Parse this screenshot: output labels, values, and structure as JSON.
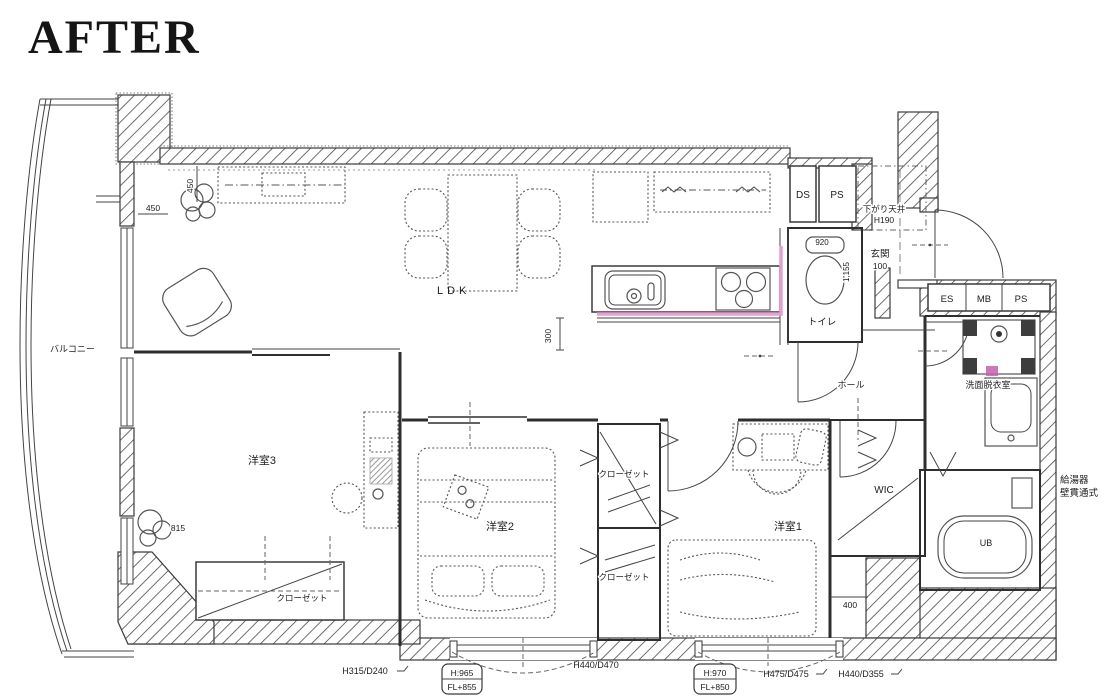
{
  "title": "AFTER",
  "colors": {
    "highlight_pink": "#e79ed3",
    "wall_line": "#3a3a3a"
  },
  "rooms": {
    "balcony": "バルコニー",
    "ldk": "LDK",
    "room3": "洋室3",
    "room2": "洋室2",
    "room1": "洋室1",
    "toilet": "トイレ",
    "entrance": "玄関",
    "hall": "ホール",
    "wic": "WIC",
    "washroom": "洗面脱衣室",
    "unit_bath": "UB",
    "closet": "クローゼット",
    "lowered_ceiling": "下がり天井",
    "lowered_ceiling_height": "H190",
    "water_heater_line1": "給湯器",
    "water_heater_line2": "壁貫通式"
  },
  "shafts": {
    "ds": "DS",
    "ps_top": "PS",
    "es": "ES",
    "mb": "MB",
    "ps_right": "PS"
  },
  "dimensions": {
    "balcony_setback_h": "450",
    "balcony_setback_v": "450",
    "counter_clearance": "300",
    "toilet_width": "920",
    "toilet_depth": "1,155",
    "entrance_step": "100",
    "room3_plant": "815",
    "room1_wall": "400"
  },
  "window_labels": {
    "w1": "H315/D240",
    "w2_height": "H:965",
    "w2_floor": "FL+855",
    "w3": "H440/D470",
    "w4_height": "H:970",
    "w4_floor": "FL+850",
    "w5": "H475/D475",
    "w6": "H440/D355"
  }
}
